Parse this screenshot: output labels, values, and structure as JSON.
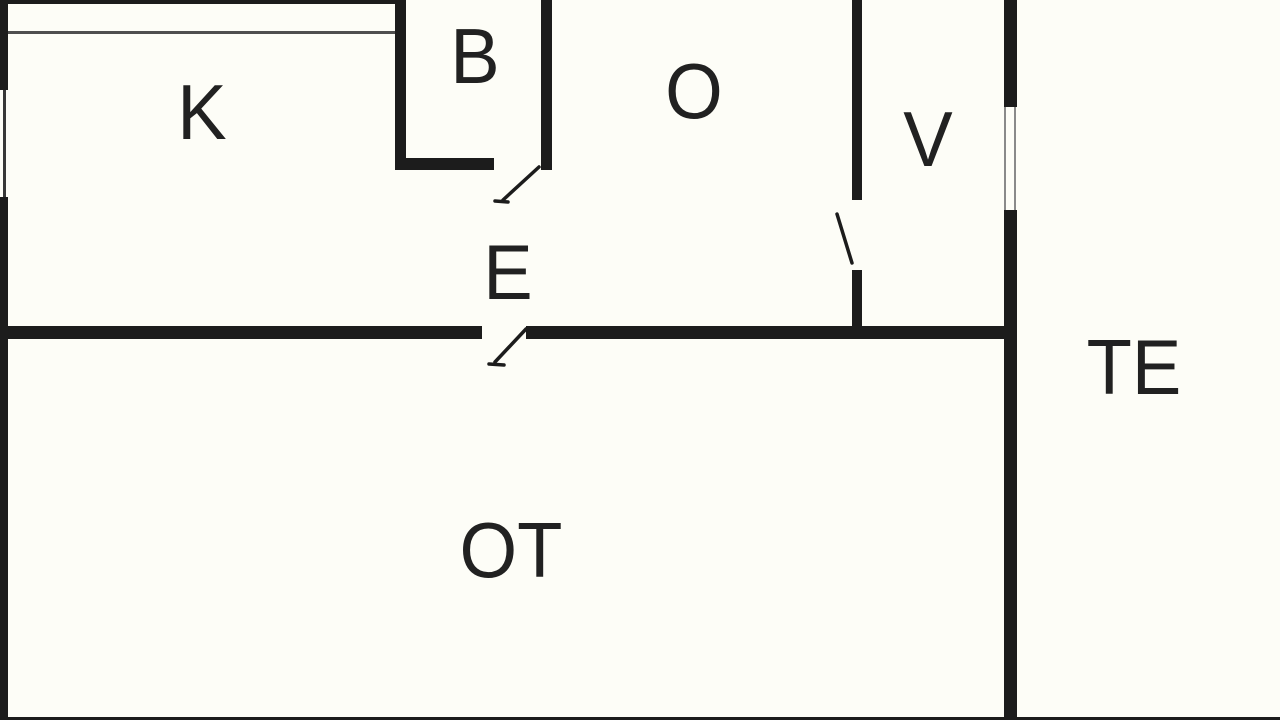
{
  "colors": {
    "background": "#fdfdf7",
    "wall": "#1c1c1c",
    "thin_line": "#4f4f4f",
    "window_line": "#8a8a8a",
    "label": "#212121"
  },
  "rooms": {
    "k": "K",
    "b": "B",
    "o": "O",
    "v": "V",
    "e": "E",
    "ot": "OT",
    "te": "TE"
  }
}
